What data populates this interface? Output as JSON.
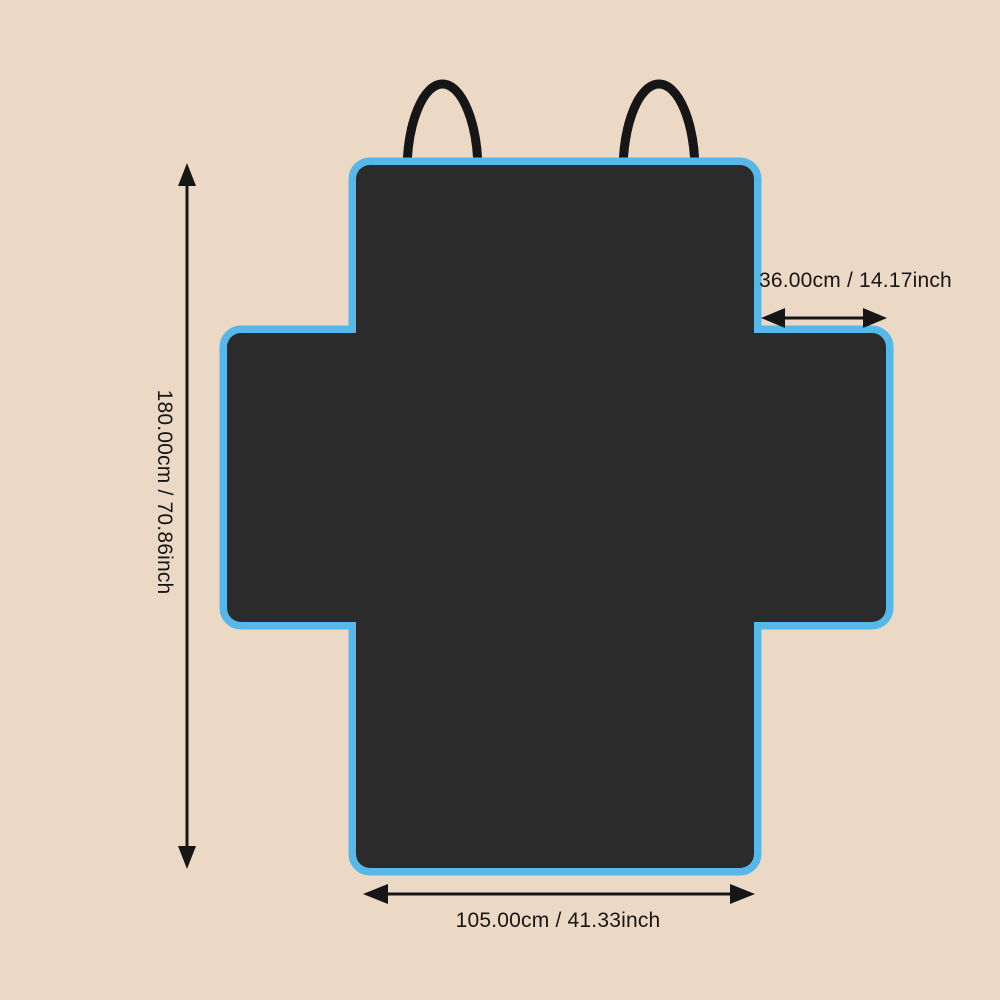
{
  "colors": {
    "background": "#ecd9c5",
    "cover_fill": "#2b2b2b",
    "trim": "#56b8e9",
    "ink": "#161616"
  },
  "graphic": {
    "name": "cross-shaped-pet-seat-cover-top-view",
    "features": [
      "blue-trim-edge",
      "two-hanging-loops"
    ]
  },
  "labels": {
    "height": "180.00cm / 70.86inch",
    "top_flap_width": "36.00cm / 14.17inch",
    "bottom_width": "105.00cm / 41.33inch"
  }
}
